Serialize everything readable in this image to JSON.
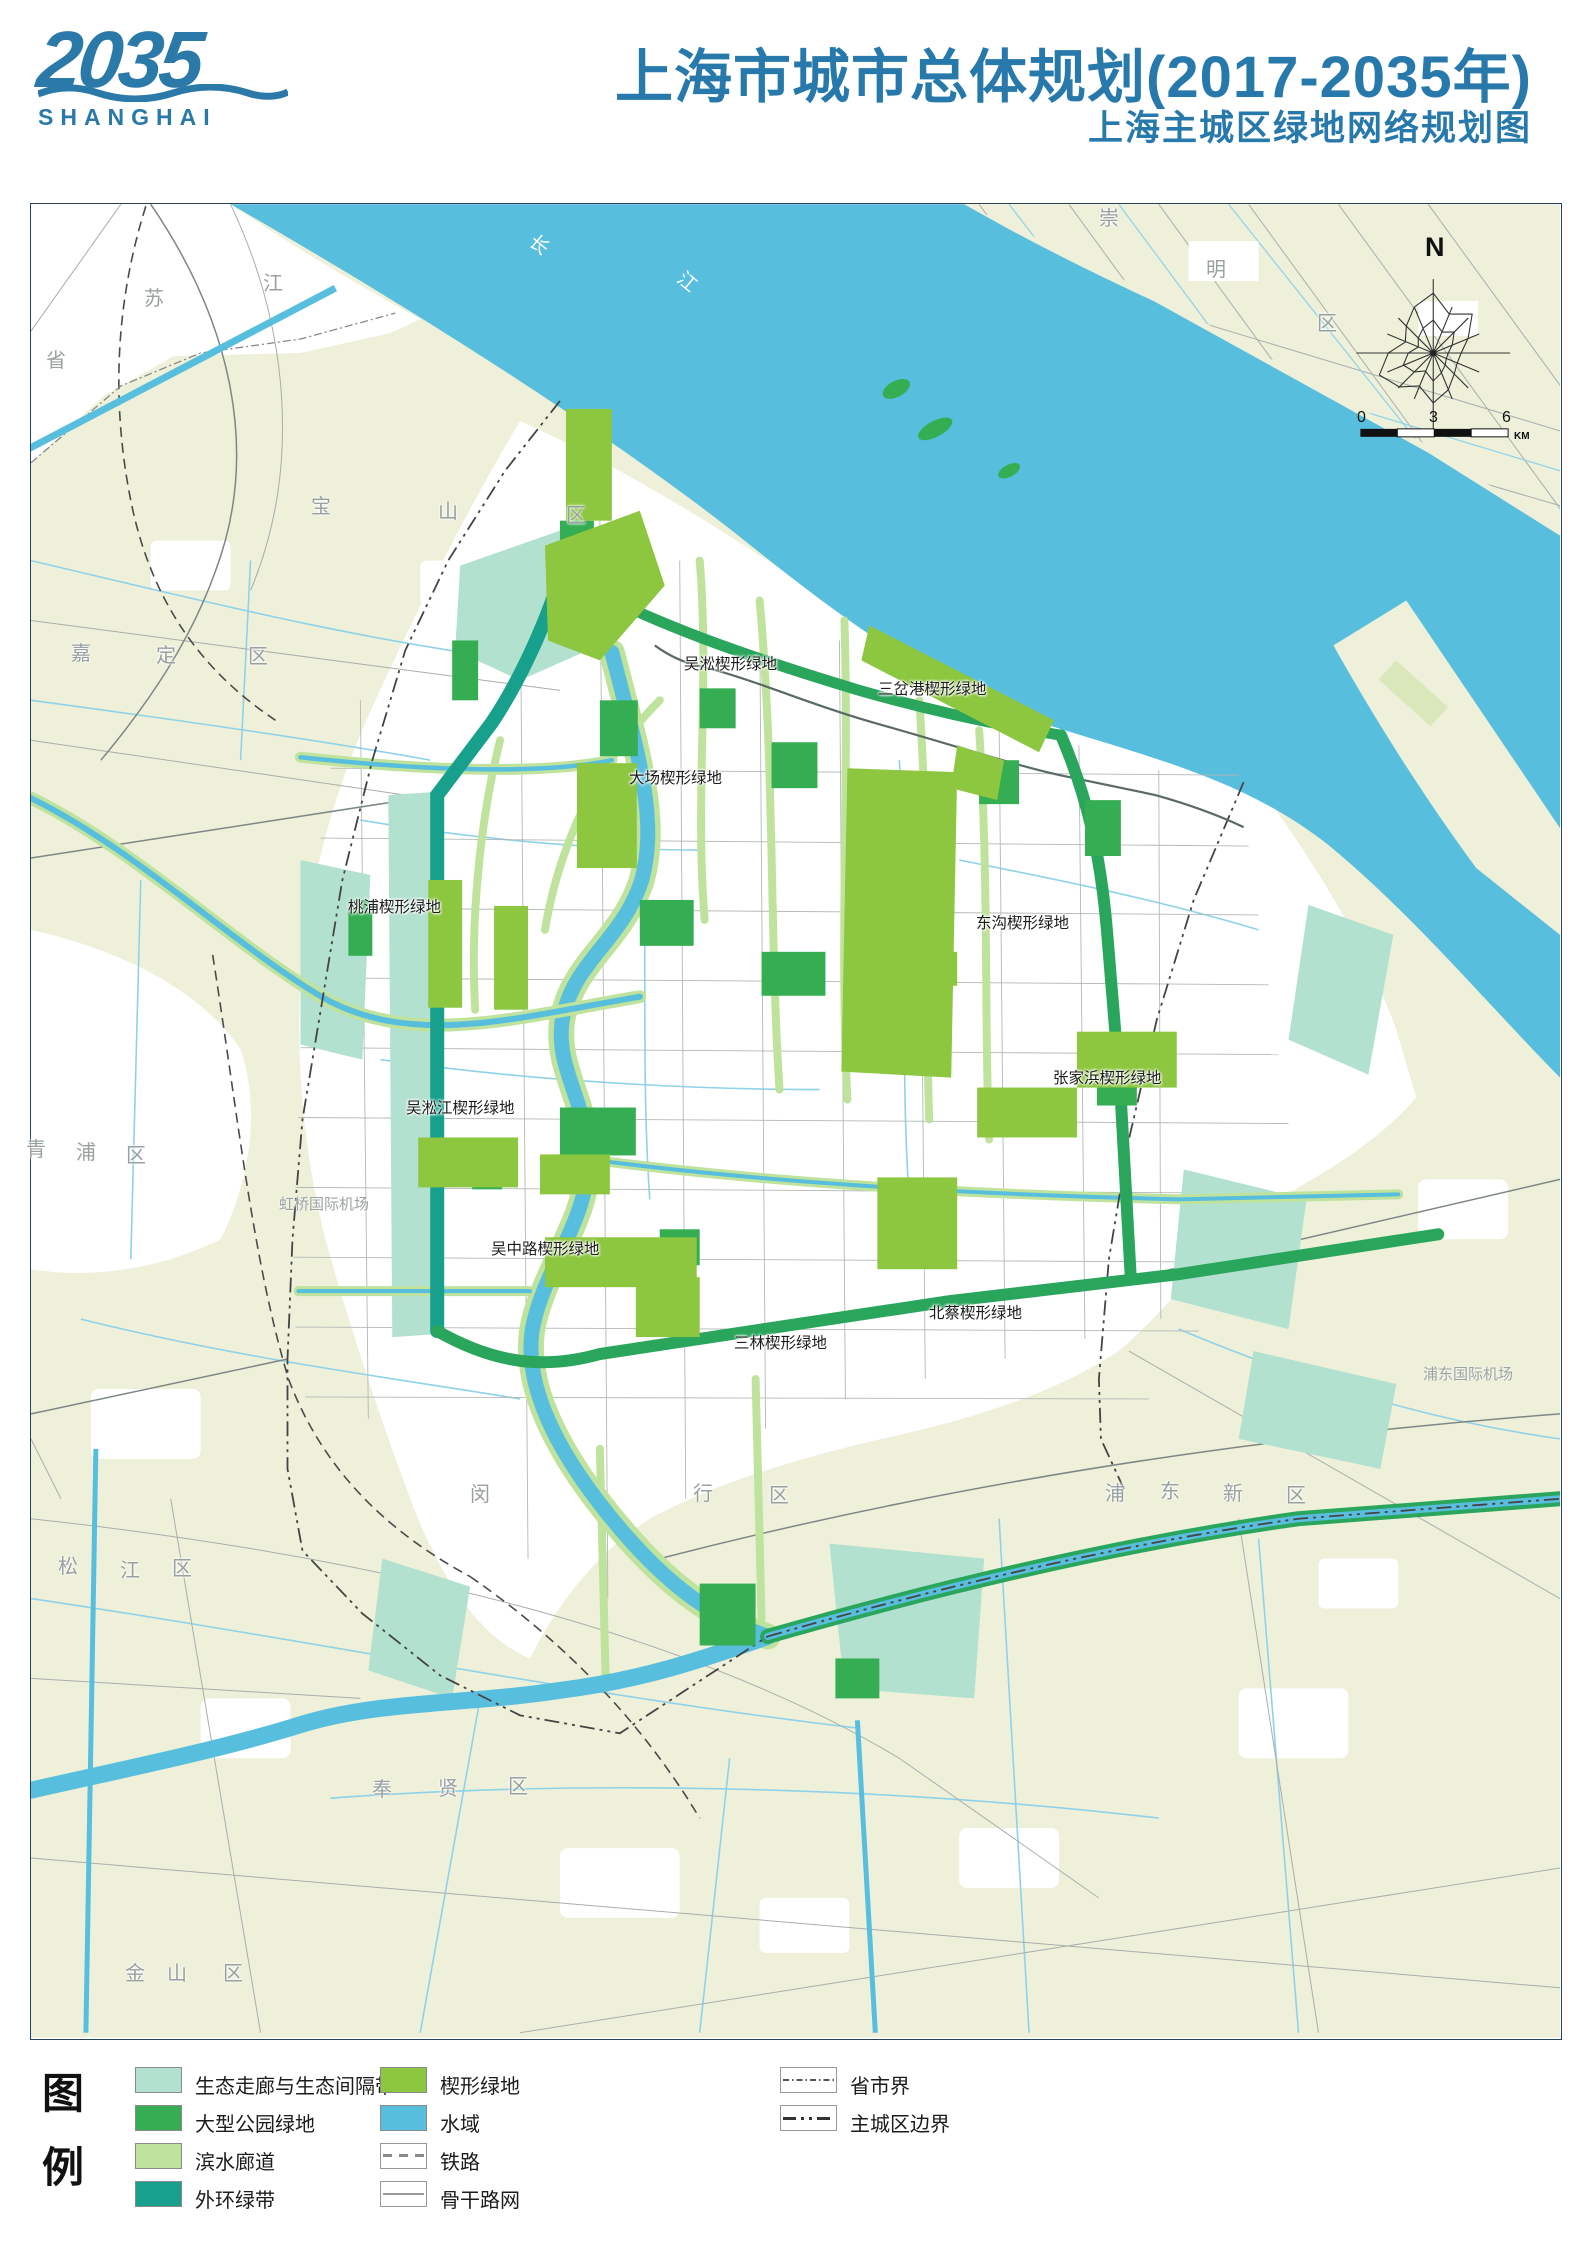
{
  "header": {
    "logo_year": "2035",
    "logo_sub": "SHANGHAI",
    "title": "上海市城市总体规划(2017-2035年)",
    "subtitle": "上海主城区绿地网络规划图"
  },
  "palette": {
    "title_blue": "#2879ab",
    "land_beige": "#eef0da",
    "water_blue": "#58bedd",
    "eco_corridor_aqua": "#b2e1cf",
    "large_park_green": "#35ad52",
    "waterfront_corridor_green": "#bfe39c",
    "outer_ring_teal": "#17a08c",
    "wedge_green": "#8dc63f",
    "road_gray": "#a8aeac",
    "boundary_dark": "#444444"
  },
  "map": {
    "labels": [
      {
        "t": "吴淞楔形绿地",
        "x": 683,
        "y": 656,
        "c": "wedge"
      },
      {
        "t": "三岔港楔形绿地",
        "x": 877,
        "y": 681,
        "c": "wedge"
      },
      {
        "t": "大场楔形绿地",
        "x": 628,
        "y": 770,
        "c": "wedge"
      },
      {
        "t": "桃浦楔形绿地",
        "x": 347,
        "y": 899,
        "c": "wedge"
      },
      {
        "t": "东沟楔形绿地",
        "x": 975,
        "y": 915,
        "c": "wedge"
      },
      {
        "t": "张家浜楔形绿地",
        "x": 1052,
        "y": 1070,
        "c": "wedge"
      },
      {
        "t": "吴淞江楔形绿地",
        "x": 405,
        "y": 1100,
        "c": "wedge"
      },
      {
        "t": "吴中路楔形绿地",
        "x": 490,
        "y": 1241,
        "c": "wedge"
      },
      {
        "t": "北蔡楔形绿地",
        "x": 928,
        "y": 1305,
        "c": "wedge"
      },
      {
        "t": "三林楔形绿地",
        "x": 733,
        "y": 1335,
        "c": "wedge"
      },
      {
        "t": "苏",
        "x": 143,
        "y": 288,
        "c": "district"
      },
      {
        "t": "江",
        "x": 262,
        "y": 273,
        "c": "district"
      },
      {
        "t": "省",
        "x": 45,
        "y": 350,
        "c": "district"
      },
      {
        "t": "长",
        "x": 528,
        "y": 235,
        "c": "river",
        "r": 40
      },
      {
        "t": "江",
        "x": 676,
        "y": 272,
        "c": "river",
        "r": 40
      },
      {
        "t": "崇",
        "x": 1098,
        "y": 208,
        "c": "district"
      },
      {
        "t": "明",
        "x": 1205,
        "y": 259,
        "c": "district"
      },
      {
        "t": "区",
        "x": 1316,
        "y": 313,
        "c": "district"
      },
      {
        "t": "嘉",
        "x": 70,
        "y": 643,
        "c": "district"
      },
      {
        "t": "定",
        "x": 155,
        "y": 645,
        "c": "district"
      },
      {
        "t": "区",
        "x": 247,
        "y": 646,
        "c": "district"
      },
      {
        "t": "宝",
        "x": 310,
        "y": 496,
        "c": "district"
      },
      {
        "t": "山",
        "x": 437,
        "y": 501,
        "c": "district"
      },
      {
        "t": "区",
        "x": 565,
        "y": 505,
        "c": "district"
      },
      {
        "t": "青",
        "x": 25,
        "y": 1139,
        "c": "district"
      },
      {
        "t": "浦",
        "x": 75,
        "y": 1142,
        "c": "district"
      },
      {
        "t": "区",
        "x": 125,
        "y": 1145,
        "c": "district"
      },
      {
        "t": "松",
        "x": 57,
        "y": 1556,
        "c": "district"
      },
      {
        "t": "江",
        "x": 119,
        "y": 1560,
        "c": "district"
      },
      {
        "t": "区",
        "x": 171,
        "y": 1558,
        "c": "district"
      },
      {
        "t": "金",
        "x": 124,
        "y": 1963,
        "c": "district"
      },
      {
        "t": "山",
        "x": 166,
        "y": 1963,
        "c": "district"
      },
      {
        "t": "区",
        "x": 222,
        "y": 1963,
        "c": "district"
      },
      {
        "t": "奉",
        "x": 371,
        "y": 1779,
        "c": "district"
      },
      {
        "t": "贤",
        "x": 437,
        "y": 1778,
        "c": "district"
      },
      {
        "t": "区",
        "x": 507,
        "y": 1776,
        "c": "district"
      },
      {
        "t": "闵",
        "x": 469,
        "y": 1484,
        "c": "district"
      },
      {
        "t": "行",
        "x": 692,
        "y": 1483,
        "c": "district"
      },
      {
        "t": "区",
        "x": 768,
        "y": 1485,
        "c": "district"
      },
      {
        "t": "浦",
        "x": 1104,
        "y": 1483,
        "c": "district"
      },
      {
        "t": "东",
        "x": 1159,
        "y": 1481,
        "c": "district"
      },
      {
        "t": "新",
        "x": 1222,
        "y": 1483,
        "c": "district"
      },
      {
        "t": "区",
        "x": 1285,
        "y": 1485,
        "c": "district"
      },
      {
        "t": "虹桥国际机场",
        "x": 278,
        "y": 1196,
        "c": "airport"
      },
      {
        "t": "浦东国际机场",
        "x": 1422,
        "y": 1366,
        "c": "airport"
      },
      {
        "t": "N",
        "x": 1424,
        "y": 233,
        "c": "compass-n"
      },
      {
        "t": "0",
        "x": 1356,
        "y": 409,
        "c": "scale-num"
      },
      {
        "t": "3",
        "x": 1428,
        "y": 409,
        "c": "scale-num"
      },
      {
        "t": "6",
        "x": 1501,
        "y": 409,
        "c": "scale-num"
      },
      {
        "t": "KM",
        "x": 1513,
        "y": 431,
        "c": "scale-unit"
      }
    ]
  },
  "legend": {
    "title_top": "图",
    "title_bottom": "例",
    "col1": [
      {
        "label": "生态走廊与生态间隔带",
        "color": "#b2e1cf"
      },
      {
        "label": "大型公园绿地",
        "color": "#35ad52"
      },
      {
        "label": "滨水廊道",
        "color": "#bfe39c"
      },
      {
        "label": "外环绿带",
        "color": "#17a08c"
      }
    ],
    "col2": [
      {
        "label": "楔形绿地",
        "color": "#8dc63f"
      },
      {
        "label": "水域",
        "color": "#58bedd"
      },
      {
        "label": "铁路",
        "line": "rail"
      },
      {
        "label": "骨干路网",
        "line": "road"
      }
    ],
    "col3": [
      {
        "label": "省市界",
        "line": "prov"
      },
      {
        "label": "主城区边界",
        "line": "city"
      }
    ]
  }
}
